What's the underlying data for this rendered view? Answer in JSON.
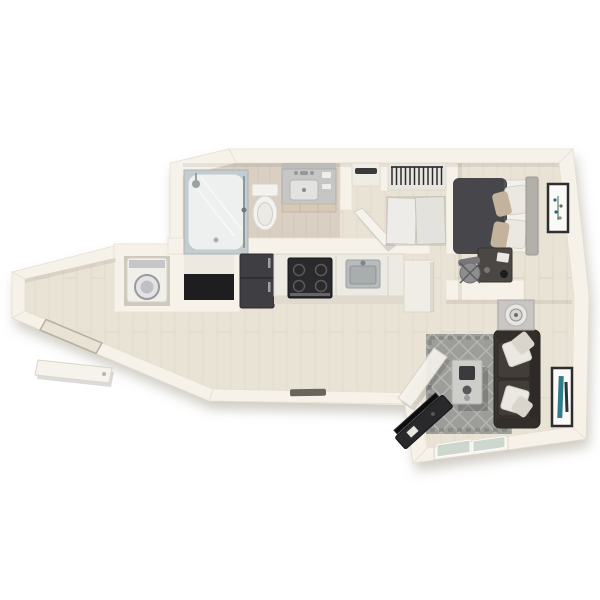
{
  "scene": {
    "kind": "3d-floor-plan-render",
    "view": "top-down isometric",
    "canvas": {
      "width": 600,
      "height": 600
    },
    "background": "#ffffff"
  },
  "colors": {
    "wall": "#f6f2ea",
    "wall_edge": "#e6dfd1",
    "unit_shadow": "rgba(130,118,98,0.38)",
    "wood": "#e9e3d6",
    "wood_line": "#ddd4c4",
    "bath_floor": "#d9cfc2",
    "bath_line": "#cbc0b1",
    "rug": "#9d9d9a",
    "rug_line": "#b6b6b3",
    "sofa": "#3a3431",
    "duvet": "#47474b",
    "headboard": "#b3b0aa",
    "sheet": "#f2f0eb",
    "pillow_tan": "#c3b29c",
    "pillow_white": "#ebe8e2",
    "coffee_table": "#cdcdca",
    "appliance_dark": "#2a2a2c",
    "fridge": "#3f3f43",
    "steel": "#b9bcbd",
    "art_teal": "#1b6f80",
    "glass": "#c9d4cb",
    "door_leaf": "#f6f3ec"
  },
  "unit": {
    "rooms": [
      {
        "name": "entry",
        "features": [
          "entry-door-open",
          "door-threshold"
        ]
      },
      {
        "name": "laundry-closet",
        "features": [
          "stacked-washer",
          "utility-shelf-niche"
        ]
      },
      {
        "name": "bathroom",
        "features": [
          "glass-shower-tub",
          "toilet",
          "vanity-with-sink",
          "mirror-cabinet",
          "bathroom-door-open"
        ]
      },
      {
        "name": "hallway",
        "features": [
          "linen-closet",
          "hanging-closet",
          "sliding-door-closet"
        ]
      },
      {
        "name": "bedroom",
        "features": [
          "bed-dark-duvet",
          "headboard",
          "white-pillows",
          "tan-accent-pillows",
          "desk",
          "desk-chair",
          "framed-botanical-art"
        ]
      },
      {
        "name": "kitchen",
        "features": [
          "refrigerator",
          "range-cooktop",
          "kitchen-sink",
          "countertop-run",
          "cabinet-peninsula"
        ]
      },
      {
        "name": "living-room",
        "features": [
          "diamond-pattern-rug",
          "coffee-table",
          "dark-sofa",
          "throw-pillows",
          "side-table-with-lamp",
          "media-console-with-tv",
          "framed-teal-art",
          "sliding-glass-door",
          "open-door-leaf"
        ]
      }
    ]
  }
}
